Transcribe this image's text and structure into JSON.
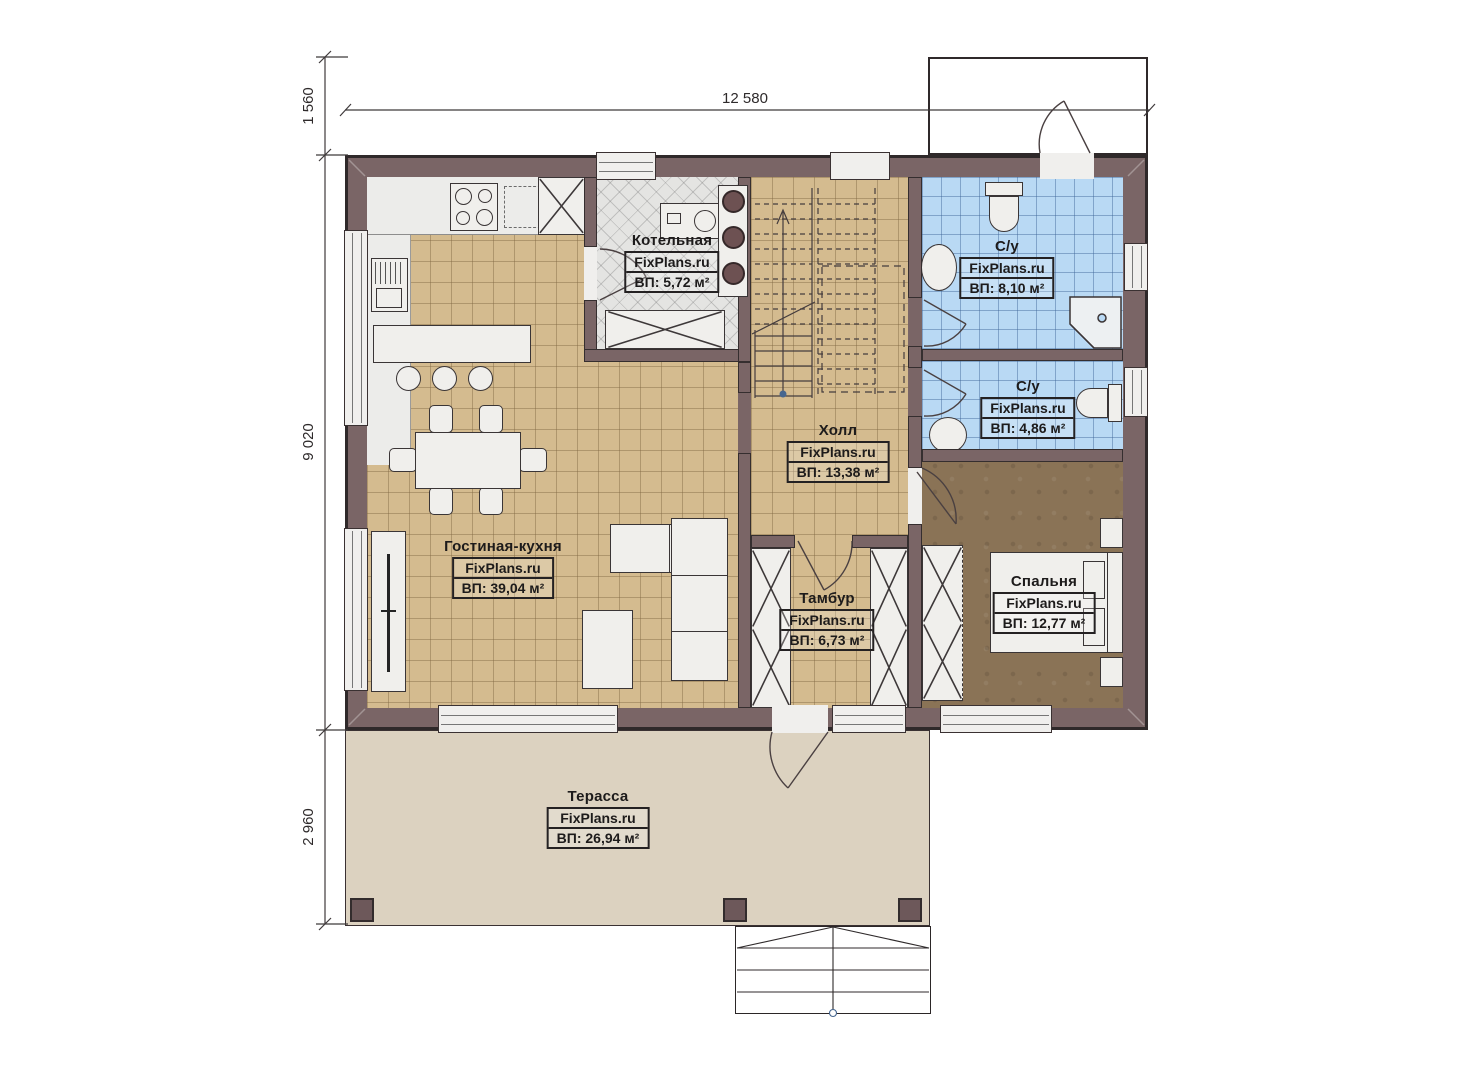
{
  "dimensions": {
    "width_top": "12 580",
    "height_upper": "1 560",
    "height_main": "9 020",
    "height_terrace": "2 960"
  },
  "watermark": "FixPlans.ru",
  "rooms": {
    "boiler": {
      "name": "Котельная",
      "area": "ВП: 5,72 м²"
    },
    "bath_top": {
      "name": "С/у",
      "area": "ВП: 8,10 м²"
    },
    "bath_bottom": {
      "name": "С/у",
      "area": "ВП: 4,86 м²"
    },
    "hall": {
      "name": "Холл",
      "area": "ВП: 13,38 м²"
    },
    "living_kitchen": {
      "name": "Гостиная-кухня",
      "area": "ВП: 39,04 м²"
    },
    "vestibule": {
      "name": "Тамбур",
      "area": "ВП: 6,73 м²"
    },
    "bedroom": {
      "name": "Спальня",
      "area": "ВП: 12,77 м²"
    },
    "terrace": {
      "name": "Терасса",
      "area": "ВП: 26,94 м²"
    }
  },
  "colors": {
    "wall": "#7a6566",
    "floor_tile_tan": "#d4bb8f",
    "floor_tile_blue": "#b9d9f4",
    "floor_boiler": "#e4e4e2",
    "floor_bedroom": "#8a7356",
    "terrace": "#dcd2c0"
  }
}
